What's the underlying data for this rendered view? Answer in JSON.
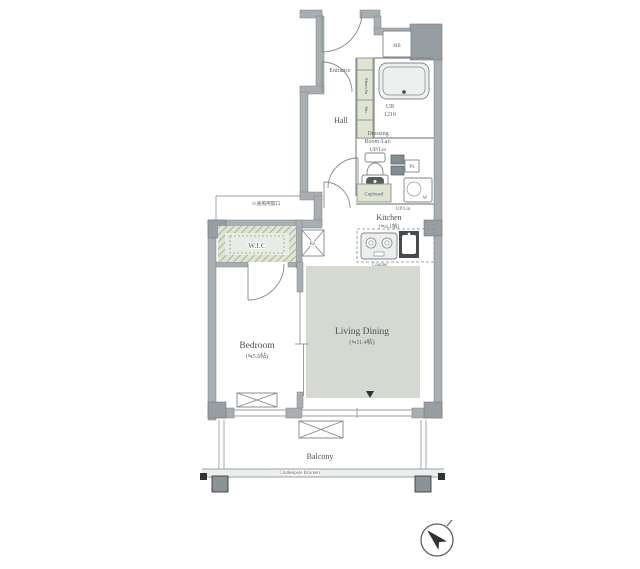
{
  "labels": {
    "entrance": "Entrance",
    "hall": "Hall",
    "shoes_in": "Shoes In",
    "storage": "Sto.",
    "unit_bath_line1": "UB",
    "unit_bath_line2": "1216",
    "dressing_line1": "Dressing",
    "dressing_line2": "Room·Lav.",
    "dressing_line3": "UP/Lin",
    "meter_box": "MB",
    "pipe_space": "PS",
    "washer": "W",
    "cupboard": "Cupboard",
    "up_lin": "UP/Lin",
    "kitchen": "Kitchen",
    "kitchen_size": "(≒4.1帖)",
    "counter": "Counter",
    "refrigerator": "Re.",
    "wic": "W.I.C",
    "vent_note": "※通風用開口",
    "bedroom": "Bedroom",
    "bedroom_size": "(≒5.6帖)",
    "living_dining": "Living Dining",
    "living_dining_size": "(≒11.4帖)",
    "balcony": "Balcony",
    "clothespole": "Clothespole Brackets"
  },
  "colors": {
    "wall": "#a8aeb1",
    "pillar": "#969ea2",
    "accent_green": "#dfe4d3",
    "accent_green_line": "#8d9782",
    "living_floor": "#d6d9d2",
    "line": "#85898c",
    "dark": "#2e3234",
    "text": "#4b5054"
  }
}
